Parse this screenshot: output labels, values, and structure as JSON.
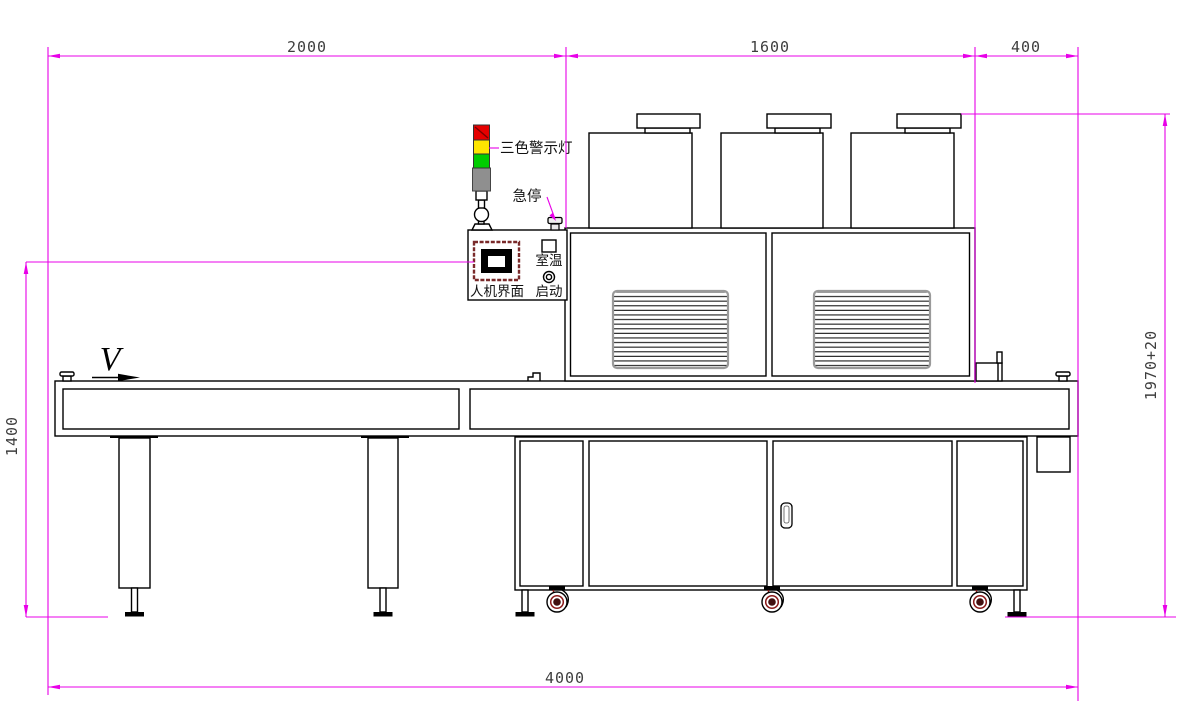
{
  "drawing_labels": {
    "tower_light": "三色警示灯",
    "emergency_stop": "急停",
    "hmi_panel": "人机界面",
    "room_temperature": "室温",
    "start_button": "启动",
    "belt_direction": "V"
  },
  "dimensions": {
    "left_section_width": "2000",
    "oven_section_width": "1600",
    "right_overhang_width": "400",
    "operator_height": "1400",
    "total_height": "1970+20",
    "total_length": "4000"
  },
  "colors": {
    "dimension_lines": "#e800e8",
    "outline": "#000000",
    "warning_red": "#e60000",
    "warning_yellow": "#ffe600",
    "warning_green": "#00cc00",
    "tower_base_gray": "#8f8f8f",
    "caster_accent": "#8b1a1a",
    "screen_bezel": "#7a2a2a"
  }
}
